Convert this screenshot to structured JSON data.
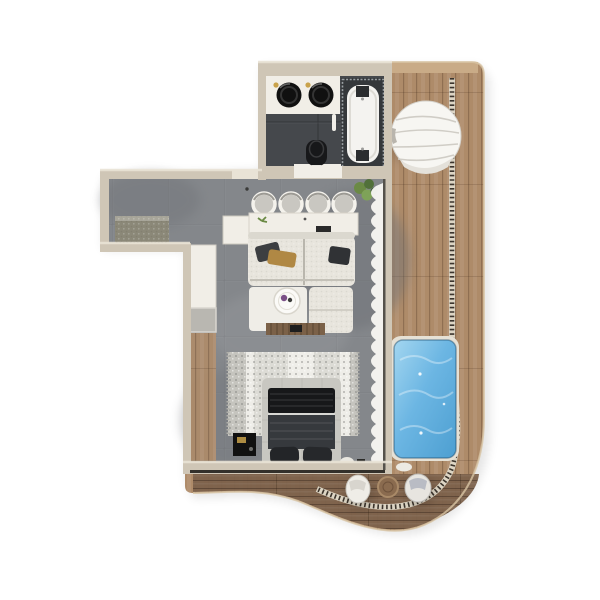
{
  "meta": {
    "description": "Top-view 3D render of a studio apartment floor plan with curved wooden pool deck",
    "visible_text": ""
  },
  "palette": {
    "bg": "#ffffff",
    "wall": "#cfc6b6",
    "wall_light": "#e9e3d6",
    "wall_white": "#f1eee7",
    "concrete": "#84878b",
    "concrete_dark": "#6d7074",
    "bath_floor": "#45484c",
    "deck_wood": "#ae8b69",
    "deck_wood_dark": "#7c614b",
    "deck_band": "#c9ab87",
    "stitch_dark": "#3b342c",
    "stitch_light": "#ddd5c4",
    "pool_water": "#6cb6e3",
    "pool_water_light": "#a3d6f0",
    "pool_water_deep": "#4d9fd1",
    "pool_frame": "#e6e1d5",
    "sofa_cream": "#e8e5dd",
    "sofa_white": "#efede7",
    "sofa_shadow": "#cfccc3",
    "pillow_mustard": "#b08844",
    "pillow_dark": "#3c3e41",
    "rug_base": "#dcdbd5",
    "rug_stripe": "#c5c4be",
    "bed_frame": "#c8c7c1",
    "bed_duvet": "#36393d",
    "bed_blanket": "#17181a",
    "wood_furniture": "#7b6148",
    "black": "#141414",
    "gold": "#c9a24b",
    "curtain": "#f7f6f2",
    "plant": "#6b8a45",
    "mat": "#8b8878"
  },
  "scene": {
    "areas": [
      {
        "name": "entry-hall"
      },
      {
        "name": "bathroom"
      },
      {
        "name": "living-kitchen"
      },
      {
        "name": "bedroom"
      },
      {
        "name": "pool-deck"
      }
    ],
    "counts": {
      "bar_stools": 4,
      "vanity_sinks": 2,
      "bed_pillows": 2,
      "deck_seats": 2
    },
    "objects": [
      "entry-doormat",
      "shoe-cabinet",
      "double-vanity",
      "vessel-sinks",
      "toilet",
      "bathtub",
      "kitchen-bar-counter",
      "bar-stools",
      "sectional-sofa",
      "throw-pillows",
      "round-coffee-table",
      "tv-console",
      "wardrobe",
      "area-rug",
      "double-bed",
      "nightstand",
      "sheer-curtain",
      "round-daybed",
      "swimming-pool",
      "lounge-seats",
      "round-side-table",
      "slat-railing",
      "potted-plant"
    ]
  }
}
